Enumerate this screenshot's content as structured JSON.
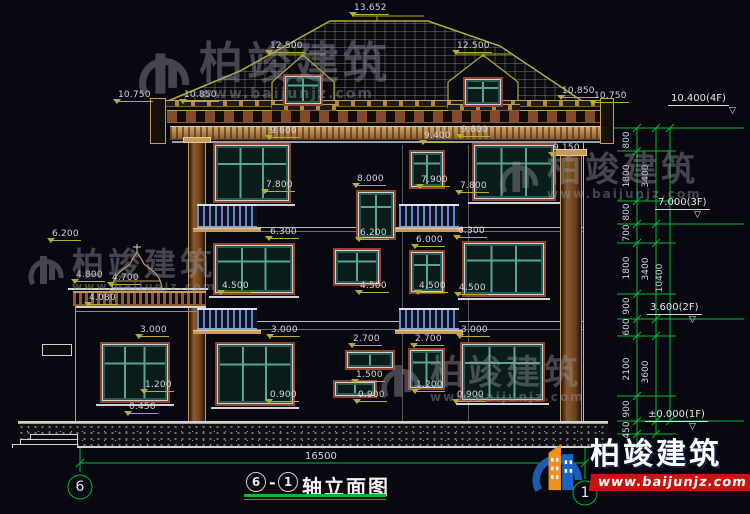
{
  "title_block": {
    "full": "⑥-①轴立面图",
    "axis_start": "6",
    "dash": "-",
    "axis_end": "1",
    "name": "轴立面图"
  },
  "axes": {
    "left_bubble": "6",
    "right_bubble": "1"
  },
  "bottom_total_dim": "16500",
  "watermark": {
    "brand": "柏竣建筑",
    "url": "www.baijunjz.com"
  },
  "logo": {
    "brand": "柏竣建筑",
    "url": "www.baijunjz.com"
  },
  "dim_labels": [
    {
      "text": "13.652",
      "x": 352,
      "y": 3
    },
    {
      "text": "12.500",
      "x": 268,
      "y": 41
    },
    {
      "text": "12.500",
      "x": 455,
      "y": 41
    },
    {
      "text": "10.750",
      "x": 116,
      "y": 90
    },
    {
      "text": "10.850",
      "x": 182,
      "y": 90
    },
    {
      "text": "10.850",
      "x": 560,
      "y": 86
    },
    {
      "text": "10.750",
      "x": 592,
      "y": 91
    },
    {
      "text": "9.600",
      "x": 268,
      "y": 126
    },
    {
      "text": "9.400",
      "x": 422,
      "y": 131
    },
    {
      "text": "9.600",
      "x": 459,
      "y": 125
    },
    {
      "text": "9.150",
      "x": 551,
      "y": 143
    },
    {
      "text": "7.800",
      "x": 264,
      "y": 180
    },
    {
      "text": "8.000",
      "x": 355,
      "y": 174
    },
    {
      "text": "7.900",
      "x": 419,
      "y": 175
    },
    {
      "text": "7.800",
      "x": 458,
      "y": 181
    },
    {
      "text": "6.200",
      "x": 50,
      "y": 229
    },
    {
      "text": "4.800",
      "x": 74,
      "y": 270
    },
    {
      "text": "4.700",
      "x": 110,
      "y": 273
    },
    {
      "text": "4.080",
      "x": 87,
      "y": 293
    },
    {
      "text": "6.300",
      "x": 268,
      "y": 227
    },
    {
      "text": "6.200",
      "x": 358,
      "y": 228
    },
    {
      "text": "6.000",
      "x": 414,
      "y": 235
    },
    {
      "text": "6.300",
      "x": 456,
      "y": 226
    },
    {
      "text": "4.500",
      "x": 220,
      "y": 281
    },
    {
      "text": "4.500",
      "x": 358,
      "y": 281
    },
    {
      "text": "4.500",
      "x": 417,
      "y": 281
    },
    {
      "text": "4.500",
      "x": 457,
      "y": 283
    },
    {
      "text": "3.000",
      "x": 138,
      "y": 325
    },
    {
      "text": "3.000",
      "x": 269,
      "y": 325
    },
    {
      "text": "3.000",
      "x": 459,
      "y": 325
    },
    {
      "text": "2.700",
      "x": 351,
      "y": 334
    },
    {
      "text": "2.700",
      "x": 413,
      "y": 334
    },
    {
      "text": "1.500",
      "x": 354,
      "y": 370
    },
    {
      "text": "1.200",
      "x": 143,
      "y": 380
    },
    {
      "text": "1.200",
      "x": 414,
      "y": 380
    },
    {
      "text": "0.900",
      "x": 268,
      "y": 390
    },
    {
      "text": "0.900",
      "x": 356,
      "y": 390
    },
    {
      "text": "0.900",
      "x": 455,
      "y": 390
    },
    {
      "text": "0.450",
      "x": 127,
      "y": 402
    }
  ],
  "right_dim_chain": {
    "segments": [
      {
        "v": "800",
        "x": 627,
        "y": 140
      },
      {
        "v": "1800",
        "x": 627,
        "y": 176
      },
      {
        "v": "800",
        "x": 627,
        "y": 212
      },
      {
        "v": "700",
        "x": 627,
        "y": 233
      },
      {
        "v": "1800",
        "x": 627,
        "y": 268
      },
      {
        "v": "900",
        "x": 627,
        "y": 306
      },
      {
        "v": "600",
        "x": 627,
        "y": 327
      },
      {
        "v": "2100",
        "x": 627,
        "y": 369
      },
      {
        "v": "900",
        "x": 627,
        "y": 409
      },
      {
        "v": "450",
        "x": 627,
        "y": 430
      }
    ],
    "group_totals": [
      {
        "v": "3400",
        "x": 646,
        "y": 176
      },
      {
        "v": "3400",
        "x": 646,
        "y": 269
      },
      {
        "v": "3600",
        "x": 646,
        "y": 372
      }
    ],
    "overall": [
      {
        "v": "10400",
        "x": 660,
        "y": 278
      }
    ]
  },
  "level_markers": [
    {
      "text": "10.400(4F)",
      "x": 668,
      "y": 93,
      "tx": 729,
      "ty": 107
    },
    {
      "text": "7.000(3F)",
      "x": 655,
      "y": 197,
      "tx": 694,
      "ty": 211
    },
    {
      "text": "3.600(2F)",
      "x": 647,
      "y": 302,
      "tx": 689,
      "ty": 316
    },
    {
      "text": "±0.000(1F)",
      "x": 645,
      "y": 409,
      "tx": 689,
      "ty": 423
    }
  ],
  "colors": {
    "background": "#070810",
    "dimension_yellow": "#b5ae2e",
    "axis_green": "#00bb33",
    "cornice_tan": "#c99a58",
    "window_frame_brown": "#93442e",
    "window_teal": "#5aa396",
    "railing_blue": "#6a86c8",
    "logo_blue": "#1a5cb0",
    "logo_orange": "#f09020",
    "logo_red_banner": "#cc1111"
  }
}
